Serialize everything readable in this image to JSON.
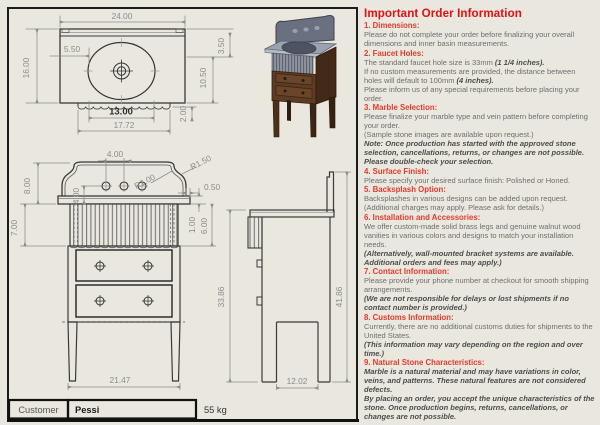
{
  "colors": {
    "background": "#eae7df",
    "frame": "#1c1c1c",
    "outline": "#3a3a3a",
    "dimension": "#8c8c8c",
    "title_red": "#e01010",
    "heading_red": "#e23b2e",
    "body_gray": "#6e6e6e",
    "wood": "#5d3b24",
    "wood_side": "#432a16",
    "marble": "#9aa3b0",
    "basin": "#4d5361",
    "splash3d": "#6a7080"
  },
  "title_block": {
    "customer_label": "Customer",
    "customer_value": "Pessi",
    "weight": "55 kg"
  },
  "dims": {
    "top_width": "24.00",
    "top_depth": "16.00",
    "basin_offset": "5.50",
    "basin_width": "13.00",
    "apron_width": "17.72",
    "scallop_depth": "2.00",
    "basin_front": "10.50",
    "splash_depth": "3.50",
    "hole_spacing": "4.00",
    "hole_drop": "4.00",
    "radius_inner": "R1.00",
    "radius_outer": "R1.50",
    "overhang": "0.50",
    "slab_thickness": "1.00",
    "apron_front": "6.00",
    "splash_height": "8.00",
    "apron_height": "7.00",
    "front_width": "21.47",
    "height_body": "33.86",
    "height_total": "41.86",
    "leg_span": "12.02"
  },
  "info_panel": {
    "title": "Important Order Information",
    "sections": [
      {
        "heading": "1. Dimensions:",
        "paragraphs": [
          [
            {
              "t": "Please do not complete your order before finalizing your overall dimensions and inner basin measurements.",
              "b": 0
            }
          ]
        ]
      },
      {
        "heading": "2. Faucet Holes:",
        "paragraphs": [
          [
            {
              "t": "The standard faucet hole size is 33mm ",
              "b": 0
            },
            {
              "t": "(1 1/4 inches).",
              "b": 1
            }
          ],
          [
            {
              "t": "If no custom measurements are provided, the distance between holes will default to 100mm ",
              "b": 0
            },
            {
              "t": "(4 inches).",
              "b": 1
            }
          ],
          [
            {
              "t": "Please inform us of any special requirements before placing your order.",
              "b": 0
            }
          ]
        ]
      },
      {
        "heading": "3. Marble Selection:",
        "paragraphs": [
          [
            {
              "t": "Please finalize your marble type and vein pattern before completing your order.",
              "b": 0
            }
          ],
          [
            {
              "t": "(Sample stone images are available upon request.)",
              "b": 0
            }
          ],
          [
            {
              "t": "Note: Once production has started with the approved stone selection, cancellations, returns, or changes are not possible. Please double-check your selection.",
              "b": 1
            }
          ]
        ]
      },
      {
        "heading": "4. Surface Finish:",
        "paragraphs": [
          [
            {
              "t": "Please specify your desired surface finish: Polished or Honed.",
              "b": 0
            }
          ]
        ]
      },
      {
        "heading": "5. Backsplash Option:",
        "paragraphs": [
          [
            {
              "t": "Backsplashes in various designs can be added upon request.",
              "b": 0
            }
          ],
          [
            {
              "t": "(Additional charges may apply. Please ask for details.)",
              "b": 0
            }
          ]
        ]
      },
      {
        "heading": "6. Installation and Accessories:",
        "paragraphs": [
          [
            {
              "t": "We offer custom-made solid brass legs and genuine walnut wood vanities in various colors and designs to match your installation needs.",
              "b": 0
            }
          ],
          [
            {
              "t": "(Alternatively, wall-mounted bracket systems are available. Additional orders and fees may apply.)",
              "b": 1
            }
          ]
        ]
      },
      {
        "heading": "7. Contact Information:",
        "paragraphs": [
          [
            {
              "t": "Please provide your phone number at checkout for smooth shipping arrangements.",
              "b": 0
            }
          ],
          [
            {
              "t": "(We are not responsible for delays or lost shipments if no contact number is provided.)",
              "b": 1
            }
          ]
        ]
      },
      {
        "heading": "8. Customs Information:",
        "paragraphs": [
          [
            {
              "t": "Currently, there are no additional customs duties for shipments to the United States.",
              "b": 0
            }
          ],
          [
            {
              "t": "(This information may vary depending on the region and over time.)",
              "b": 1
            }
          ]
        ]
      },
      {
        "heading": "9. Natural Stone Characteristics:",
        "paragraphs": [
          [
            {
              "t": "Marble is a natural material and may have variations in color, veins, and patterns. These natural features are not considered defects.",
              "b": 1
            }
          ],
          [
            {
              "t": "By placing an order, you accept the unique characteristics of the stone. Once production begins, returns, cancellations, or changes are not possible.",
              "b": 1
            }
          ]
        ]
      }
    ]
  }
}
